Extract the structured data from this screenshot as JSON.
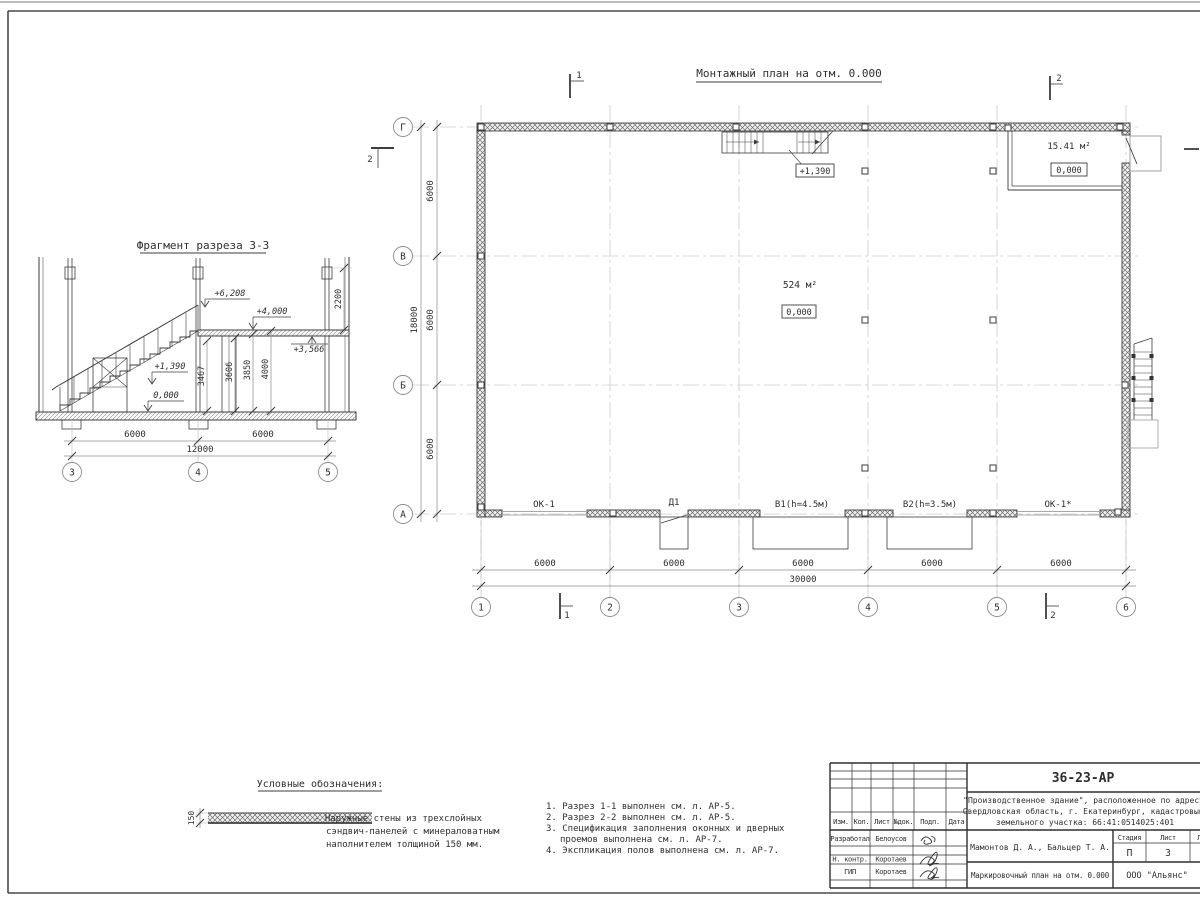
{
  "sheet": {
    "bg": "#ffffff",
    "frame_color": "#4a4a4a"
  },
  "section_fragment": {
    "title": "Фрагмент разреза 3-3",
    "elev_6208": "+6,208",
    "elev_4000": "+4,000",
    "elev_3566": "+3,566",
    "elev_1390": "+1,390",
    "elev_0": "0,000",
    "vdim_3467": "3467",
    "vdim_3606": "3606",
    "vdim_3850": "3850",
    "vdim_4000": "4000",
    "vdim_2200": "2200",
    "dim_left": "6000",
    "dim_right": "6000",
    "dim_total": "12000",
    "axis_3": "3",
    "axis_4": "4",
    "axis_5": "5"
  },
  "plan": {
    "title": "Монтажный план на отм. 0.000",
    "area_main": "524 м²",
    "level_main": "0,000",
    "room_area": "15.41 м²",
    "room_level": "0,000",
    "stair_level": "+1,390",
    "label_ok1": "ОК-1",
    "label_d1": "Д1",
    "label_v1": "В1(h=4.5м)",
    "label_v2": "В2(h=3.5м)",
    "label_ok1s": "ОК-1*",
    "dims_bottom": [
      "6000",
      "6000",
      "6000",
      "6000",
      "6000"
    ],
    "dim_total_bottom": "30000",
    "dims_left": [
      "6000",
      "6000",
      "6000"
    ],
    "dim_total_left": "18000",
    "axes_bottom": [
      "1",
      "2",
      "3",
      "4",
      "5",
      "6"
    ],
    "axes_left": [
      "Г",
      "В",
      "Б",
      "А"
    ],
    "mark_1": "1",
    "mark_2": "2"
  },
  "legend": {
    "title": "Условные обозначения:",
    "thickness": "150",
    "lines": [
      "- Наружные стены из трехслойных",
      "сэндвич-панелей с минераловатным",
      "наполнителем толщиной 150 мм."
    ]
  },
  "notes": {
    "lines": [
      "1. Разрез 1-1 выполнен см. л. АР-5.",
      "2. Разрез 2-2 выполнен см. л. АР-5.",
      "3. Спецификация заполнения оконных и дверных",
      "проемов выполнена см. л. АР-7.",
      "4. Экспликация полов выполнена см. л. АР-7."
    ]
  },
  "title_block": {
    "doc_number": "36-23-АР",
    "project_lines": [
      "\"Производственное здание\", расположенное по адресу:",
      "Свердловская область, г. Екатеринбург, кадастровый н",
      "земельного участка: 66:41:0514025:401"
    ],
    "col_headers": [
      "Изм.",
      "Кол.",
      "Лист",
      "№док.",
      "Подп.",
      "Дата"
    ],
    "row_roles": [
      "Разработал",
      "Н. контр.",
      "ГИП"
    ],
    "row_names": [
      "Белоусов",
      "Коротаев",
      "Коротаев"
    ],
    "authors": "Мамонтов Д. А., Бальцер Т. А.",
    "stage_header": "Стадия",
    "sheet_header": "Лист",
    "sheets_header": "Лист",
    "stage": "П",
    "sheet_number": "3",
    "drawing_title": "Маркировочный план на отм. 0.000",
    "org": "ООО \"Альянс\""
  }
}
